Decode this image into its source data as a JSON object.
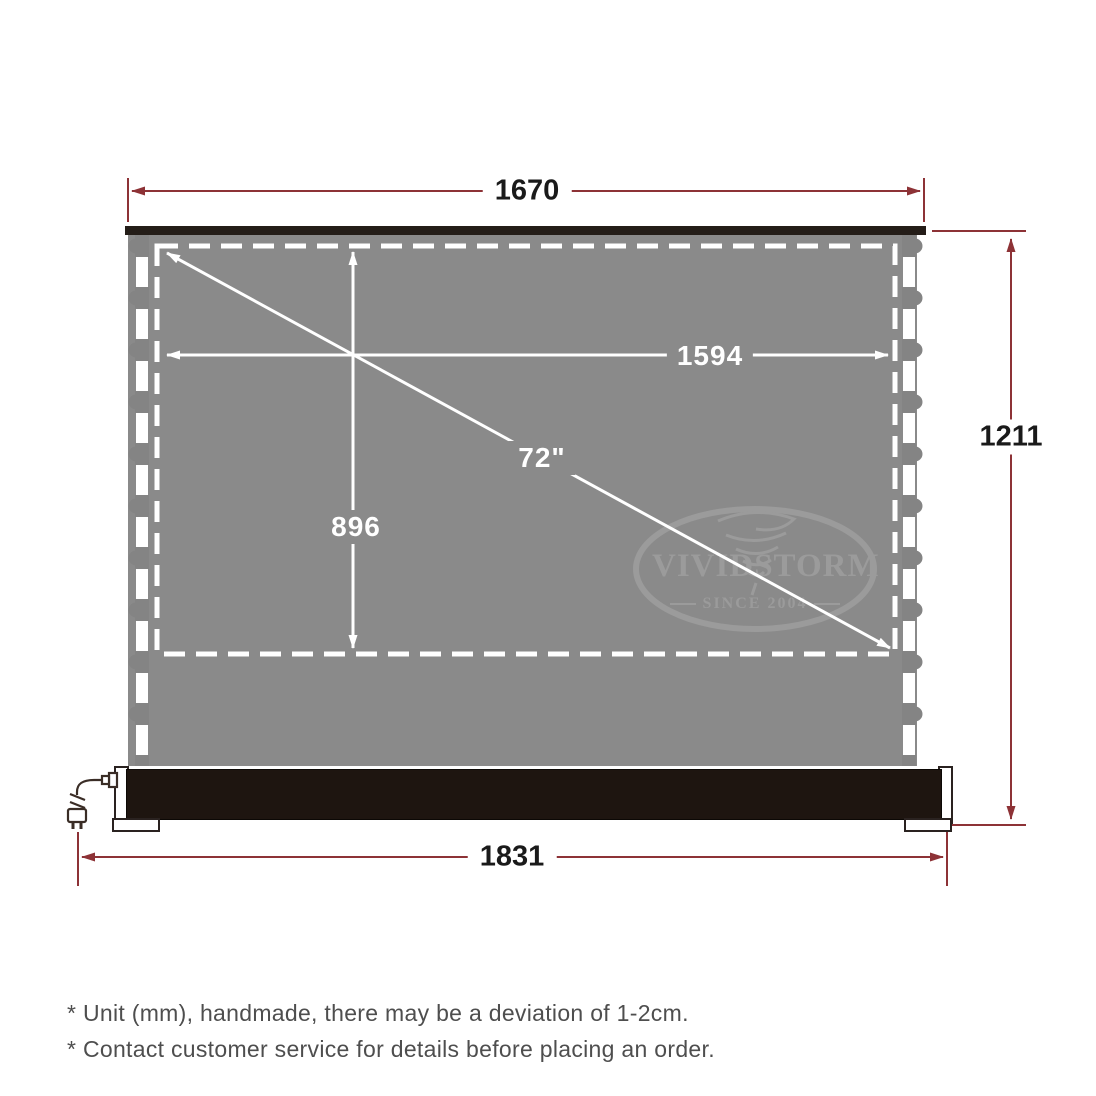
{
  "diagram": {
    "dimensions": {
      "top_width": "1670",
      "viewing_width": "1594",
      "viewing_height": "896",
      "diagonal": "72\"",
      "total_height": "1211",
      "base_width": "1831"
    },
    "logo": {
      "name_left": "VIVID",
      "name_right": "STORM",
      "tagline": "SINCE 2004"
    },
    "notes": {
      "line1": "* Unit (mm), handmade, there may be a deviation of 1-2cm.",
      "line2": "* Contact customer service for details before placing an order."
    },
    "colors": {
      "dimension_line": "#8d3236",
      "dimension_text_dark": "#1a1a1a",
      "dimension_text_light": "#ffffff",
      "screen_gray": "#8a8a8a",
      "top_bar_dark": "#241d18",
      "base_dark": "#1e1510",
      "logo_gray": "#9b9b9b",
      "note_text": "#4e4e4e"
    }
  }
}
